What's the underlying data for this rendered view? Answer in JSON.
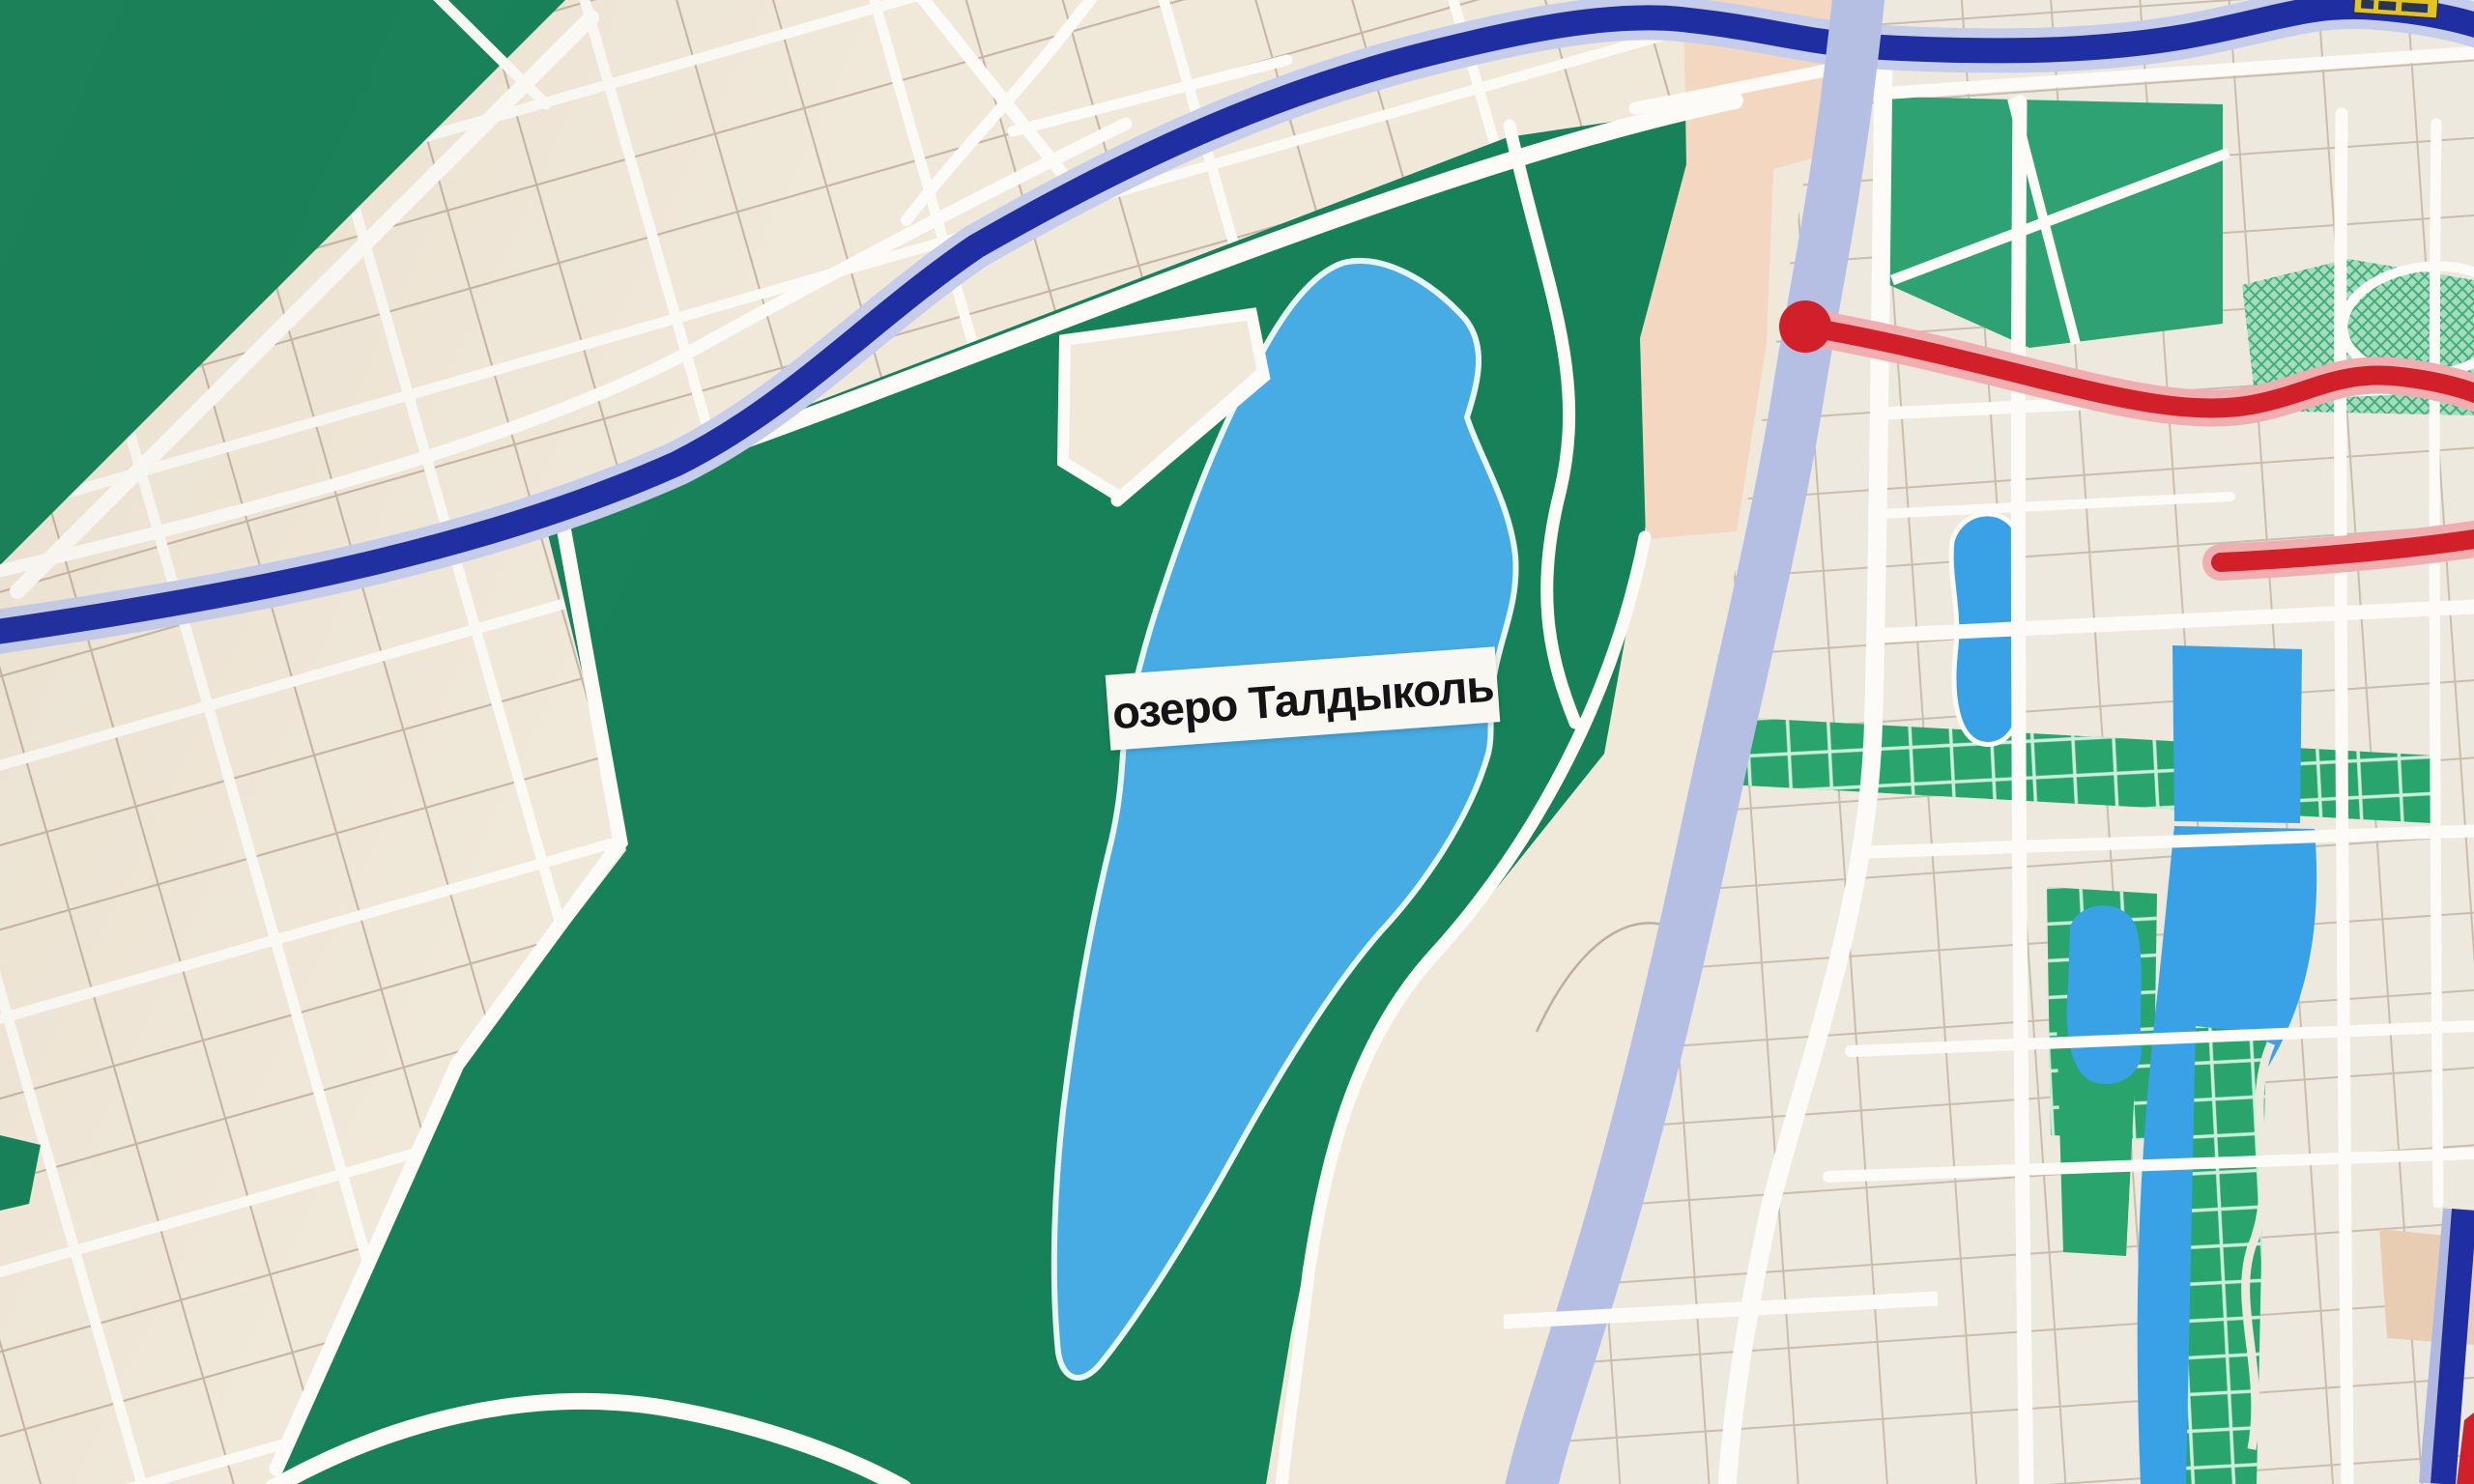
{
  "map": {
    "lake_label": "озеро Талдыколь",
    "colors": {
      "paper": "#F0E8D9",
      "paper_east": "#EDE9DE",
      "park_green": "#17825A",
      "teal_green": "#2EA273",
      "boulevard_green": "#29A46D",
      "hatch_green": "#A6DCBC",
      "hatch_line": "#3FAE7D",
      "boulevard_grid": "#CBEEDA",
      "lake_blue": "#47ACE3",
      "pond_blue": "#39A2E6",
      "river_lavender": "#B5BFE3",
      "highway_blue": "#1F2FA2",
      "highway_casing": "#C5CDEB",
      "metro_red": "#D2202A",
      "metro_casing": "#F1AEB1",
      "road_white": "#FCFBF7",
      "block_line": "#C4B6A6",
      "special_zone_peach": "#F3D7C0",
      "building_tan": "#E9CDB2",
      "sign_yellow": "#E4C31F",
      "label_bg": "#F8F7F2",
      "label_text": "#141414"
    }
  }
}
